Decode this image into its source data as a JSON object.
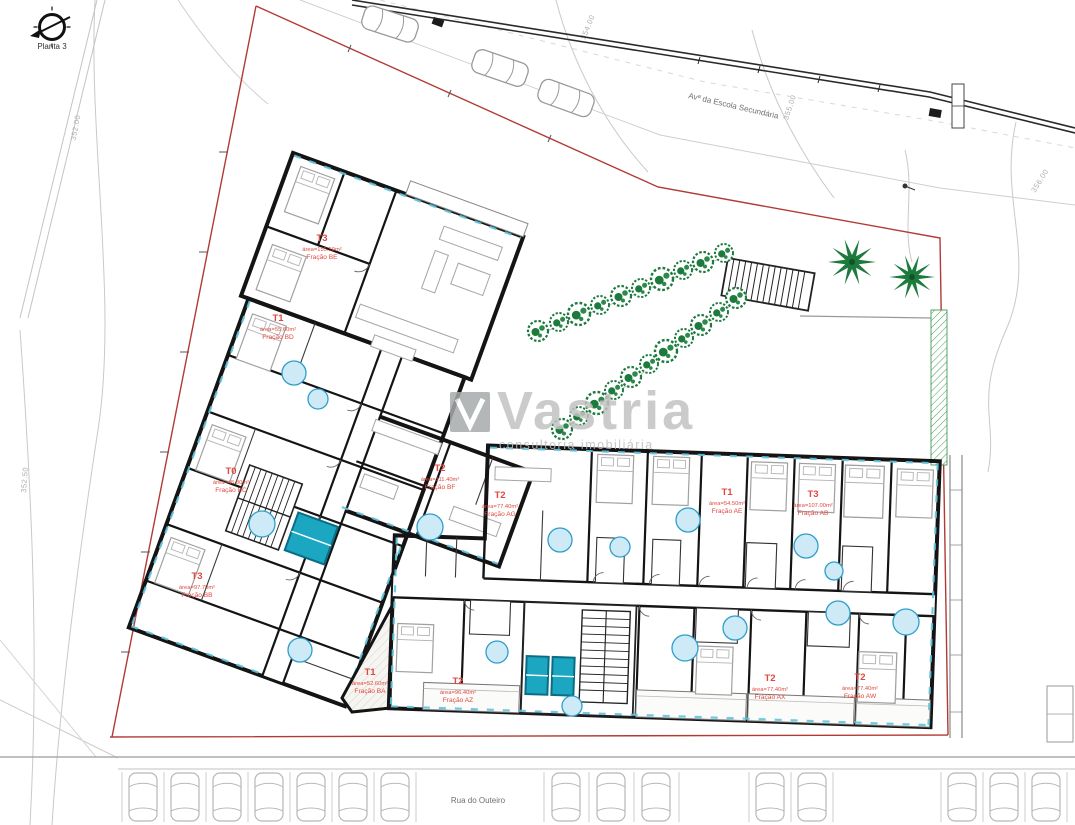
{
  "plan": {
    "sheet_label": "Planta 3",
    "streets": {
      "avenue": "Avª da Escola Secundária",
      "street_bottom": "Rua do Outeiro"
    },
    "contour_labels": [
      "352.00",
      "352.50",
      "354.00",
      "355.00",
      "356.00"
    ],
    "watermark": {
      "brand": "Vastria",
      "tagline": "consultoria imobiliária"
    },
    "units": [
      {
        "type": "T3",
        "area": "área=155.50m²",
        "fraction": "Fração BE"
      },
      {
        "type": "T1",
        "area": "área=55.60m²",
        "fraction": "Fração BD"
      },
      {
        "type": "T0",
        "area": "área=45.80m²",
        "fraction": "Fração BC"
      },
      {
        "type": "T3",
        "area": "área=97.70m²",
        "fraction": "Fração BB"
      },
      {
        "type": "T2",
        "area": "área=111.40m²",
        "fraction": "Fração BF"
      },
      {
        "type": "T1",
        "area": "área=52.60m²",
        "fraction": "Fração BA"
      },
      {
        "type": "T2",
        "area": "área=77.40m²",
        "fraction": "Fração AG"
      },
      {
        "type": "T1",
        "area": "área=54.50m²",
        "fraction": "Fração AE"
      },
      {
        "type": "T3",
        "area": "área=107.00m²",
        "fraction": "Fração AB"
      },
      {
        "type": "T2",
        "area": "área=96.40m²",
        "fraction": "Fração AZ"
      },
      {
        "type": "T2",
        "area": "área=77.40m²",
        "fraction": "Fração AX"
      },
      {
        "type": "T2",
        "area": "área=77.40m²",
        "fraction": "Fração AW"
      }
    ],
    "colors": {
      "unit_label": "#e0483f",
      "boundary": "#b23a34",
      "vegetation": "#1d7a3d",
      "elevator": "#1ba6c2",
      "window_tick": "#5fc3de",
      "watermark": "#c2c2c2"
    }
  }
}
